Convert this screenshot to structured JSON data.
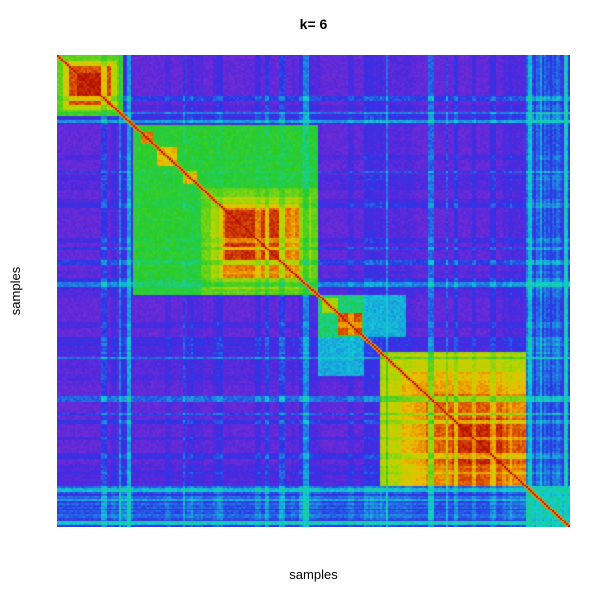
{
  "chart_data": {
    "type": "heatmap",
    "title": "k= 6",
    "xlabel": "samples",
    "ylabel": "samples",
    "k": 6,
    "description": "Consensus clustering matrix ordered by cluster, k=6. Diagonal = 1 (red). Low consensus = violet/purple, mid = blue/cyan/green, high = yellow/orange/red.",
    "value_range": [
      0,
      1
    ],
    "base_value": 0.05,
    "diagonal_value": 1.0,
    "grid": {
      "n": 256,
      "seed": 1234
    },
    "colormap": {
      "low_label": "0 (never clustered together)",
      "high_label": "1 (always clustered together)",
      "stops": [
        [
          0.0,
          "#7B2BD2"
        ],
        [
          0.1,
          "#4A2ADF"
        ],
        [
          0.17,
          "#2B35E8"
        ],
        [
          0.28,
          "#1E8AE0"
        ],
        [
          0.38,
          "#10CFD4"
        ],
        [
          0.5,
          "#28CC28"
        ],
        [
          0.62,
          "#7FD413"
        ],
        [
          0.72,
          "#BBD400"
        ],
        [
          0.8,
          "#EDBE00"
        ],
        [
          0.88,
          "#E87C00"
        ],
        [
          0.94,
          "#D44200"
        ],
        [
          1.0,
          "#B51200"
        ]
      ]
    },
    "clusters": [
      {
        "id": 1,
        "range": [
          0.0,
          0.127
        ],
        "core_consensus": 0.95
      },
      {
        "id": 2,
        "range": [
          0.148,
          0.28
        ],
        "core_consensus": 0.85
      },
      {
        "id": 3,
        "range": [
          0.28,
          0.509
        ],
        "core_consensus": 0.95
      },
      {
        "id": 4,
        "range": [
          0.509,
          0.596
        ],
        "core_consensus": 0.9
      },
      {
        "id": 5,
        "range": [
          0.627,
          0.916
        ],
        "core_consensus": 0.97
      },
      {
        "id": 6,
        "range": [
          0.916,
          1.0
        ],
        "core_consensus": 0.4
      }
    ],
    "blocks": [
      {
        "x": [
          0.0,
          0.127
        ],
        "v": 0.58
      },
      {
        "x": [
          0.012,
          0.117
        ],
        "v": 0.76
      },
      {
        "x": [
          0.023,
          0.107
        ],
        "v": 0.93
      },
      {
        "x": [
          0.04,
          0.092
        ],
        "v": 0.985
      },
      {
        "x": [
          0.148,
          0.509
        ],
        "v": 0.5
      },
      {
        "x": [
          0.166,
          0.186
        ],
        "v": 0.88
      },
      {
        "x": [
          0.197,
          0.236
        ],
        "v": 0.82
      },
      {
        "x": [
          0.246,
          0.272
        ],
        "v": 0.9
      },
      {
        "x": [
          0.28,
          0.509
        ],
        "v": 0.6
      },
      {
        "x": [
          0.3,
          0.497
        ],
        "v": 0.72
      },
      {
        "x": [
          0.318,
          0.474
        ],
        "v": 0.88
      },
      {
        "x": [
          0.327,
          0.432
        ],
        "v": 0.96
      },
      {
        "x": [
          0.509,
          0.596
        ],
        "v": 0.45
      },
      {
        "x": [
          0.515,
          0.545
        ],
        "v": 0.68
      },
      {
        "x": [
          0.548,
          0.594
        ],
        "v": 0.92
      },
      {
        "x": [
          0.509,
          0.596
        ],
        "y": [
          0.596,
          0.68
        ],
        "v": 0.32
      },
      {
        "x": [
          0.627,
          0.916
        ],
        "v": 0.76
      },
      {
        "x": [
          0.672,
          0.916
        ],
        "v": 0.84
      },
      {
        "x": [
          0.72,
          0.916
        ],
        "v": 0.91
      },
      {
        "x": [
          0.768,
          0.916
        ],
        "v": 0.97
      },
      {
        "x": [
          0.916,
          1.0
        ],
        "v": 0.25
      }
    ],
    "noise": {
      "pull": 0.42,
      "start_p": 0.11,
      "amp_base": 0.1,
      "amp_var": 0.55,
      "jitter": 0.07,
      "ranges": [
        {
          "range": [
            0.122,
            0.15
          ],
          "s": 0.16
        },
        {
          "range": [
            0.262,
            0.285
          ],
          "s": 0.08
        },
        {
          "range": [
            0.495,
            0.515
          ],
          "s": 0.1
        },
        {
          "range": [
            0.596,
            0.632
          ],
          "s": 0.15
        },
        {
          "range": [
            0.627,
            0.7
          ],
          "s": 0.07
        },
        {
          "range": [
            0.868,
            0.918
          ],
          "s": 0.1
        },
        {
          "range": [
            0.916,
            1.0
          ],
          "s": 0.35
        }
      ]
    }
  },
  "labels": {
    "title_color": "#000000",
    "axis_label_color": "#000000"
  }
}
